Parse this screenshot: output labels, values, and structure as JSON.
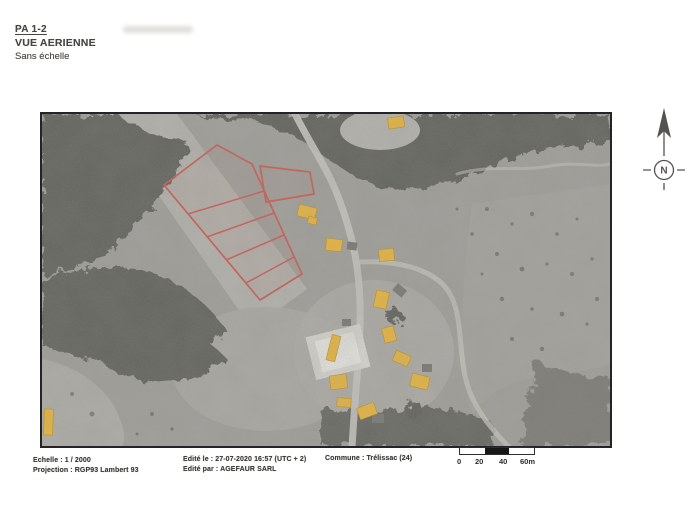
{
  "header": {
    "doc_ref": "PA 1-2",
    "title": "VUE AERIENNE",
    "scale_note": "Sans échelle"
  },
  "footer": {
    "scale": "Echelle : 1 / 2000",
    "projection": "Projection : RGP93 Lambert 93",
    "edited_date": "Edité le : 27-07-2020 16:57 (UTC + 2)",
    "edited_by": "Edité par : AGEFAUR SARL",
    "commune": "Commune : Trélissac (24)"
  },
  "scale_bar": {
    "labels": [
      "0",
      "20",
      "40",
      "60m"
    ]
  },
  "north_arrow": {
    "label": "N"
  },
  "map": {
    "description": "Grayscale aerial photograph with red project-parcel outlines and yellow highlighted buildings",
    "colors": {
      "parcel_outline": "#cf5c52",
      "building_highlight": "#edb93f",
      "forest_dark": "#63635d",
      "road_light": "#cac9c3",
      "photo_base": "#a3a29d"
    }
  }
}
